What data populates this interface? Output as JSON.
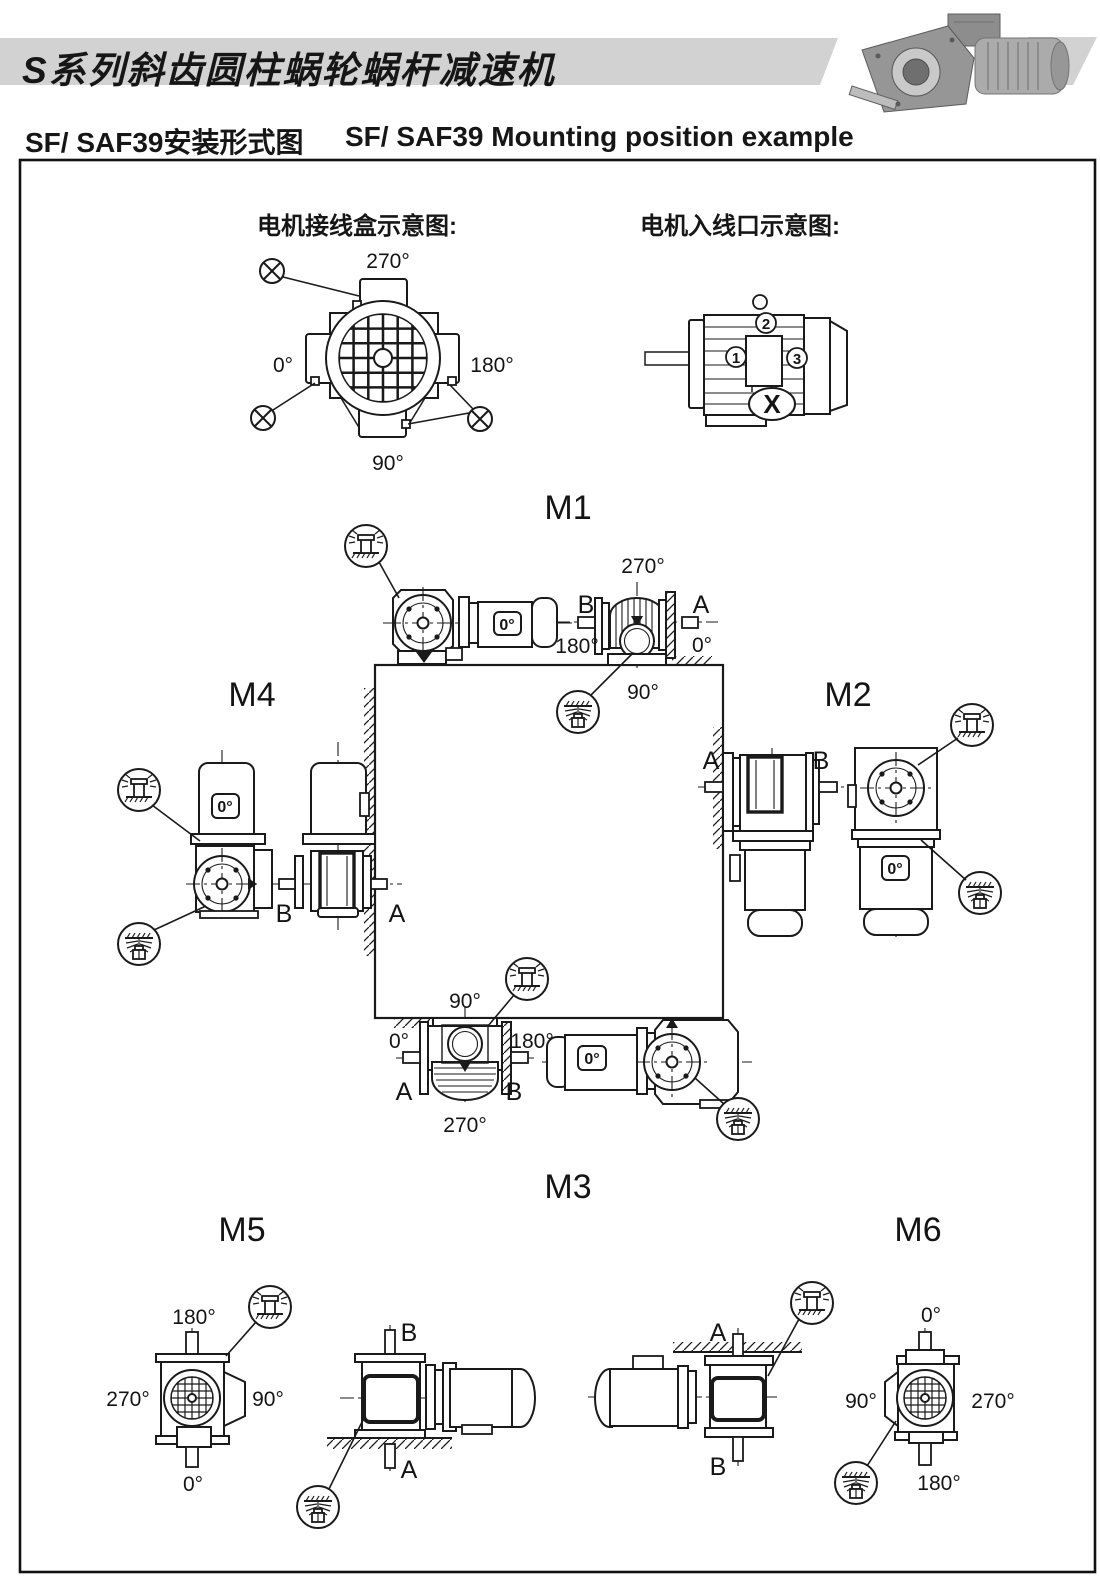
{
  "header": {
    "title": "S系列斜齿圆柱蜗轮蜗杆减速机",
    "subtitle_cn": "SF/ SAF39安装形式图",
    "subtitle_en": "SF/ SAF39 Mounting position example"
  },
  "colors": {
    "band": "#d2d2d2",
    "ink": "#1a1a1a",
    "paper": "#ffffff"
  },
  "legend_junction_box": {
    "title": "电机接线盒示意图:",
    "deg_top": "270°",
    "deg_left": "0°",
    "deg_right": "180°",
    "deg_bottom": "90°",
    "marker_symbol": "circled-x"
  },
  "legend_cable_entry": {
    "title": "电机入线口示意图:",
    "n1": "1",
    "n2": "2",
    "n3": "3",
    "x": "X"
  },
  "m1": {
    "title": "M1",
    "motor_angle": "0°",
    "deg270": "270°",
    "b": "B",
    "a": "A",
    "deg180": "180°",
    "deg0": "0°",
    "deg90": "90°"
  },
  "m2": {
    "title": "M2",
    "a": "A",
    "b": "B",
    "motor_angle": "0°"
  },
  "m3": {
    "title": "M3",
    "deg90": "90°",
    "deg0": "0°",
    "deg180": "180°",
    "a": "A",
    "b": "B",
    "deg270": "270°",
    "motor_angle": "0°"
  },
  "m4": {
    "title": "M4",
    "motor_angle": "0°",
    "b": "B",
    "a": "A"
  },
  "m5": {
    "title": "M5",
    "deg180": "180°",
    "deg270": "270°",
    "deg90": "90°",
    "deg0": "0°",
    "b": "B",
    "a": "A"
  },
  "m6": {
    "title": "M6",
    "a": "A",
    "b": "B",
    "deg0": "0°",
    "deg90": "90°",
    "deg270": "270°",
    "deg180": "180°"
  }
}
